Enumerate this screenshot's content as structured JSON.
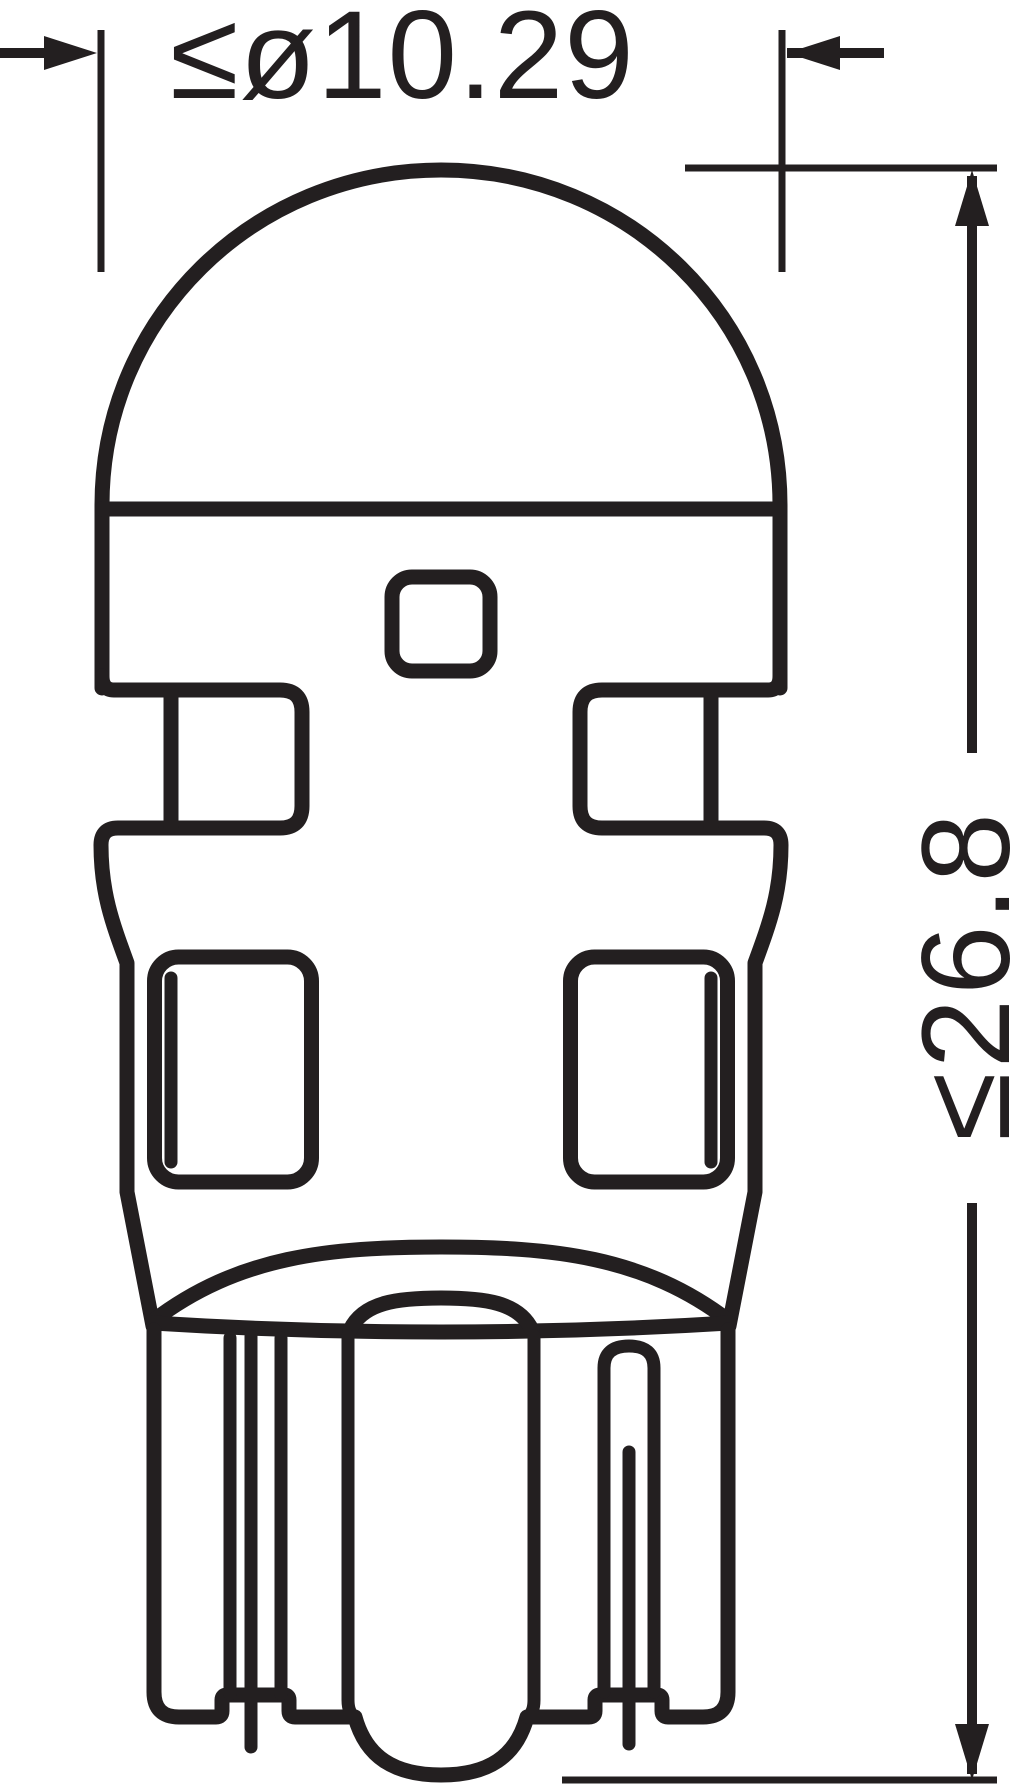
{
  "drawing": {
    "kind": "bulb-technical-dimension-drawing",
    "labels": {
      "diameter": "≤ø10.29",
      "height": "≤26.8"
    },
    "colors": {
      "line": "#231f20",
      "background": "#ffffff"
    }
  }
}
